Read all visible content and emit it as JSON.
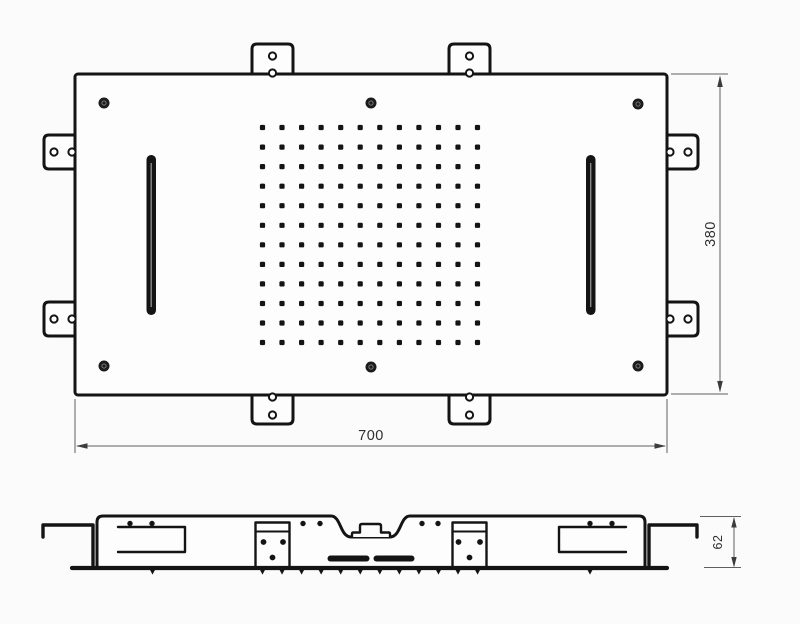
{
  "dimensions": {
    "width": "700",
    "height": "380",
    "depth": "62"
  },
  "colors": {
    "line": "#141414",
    "dim_line": "#5f5f5f",
    "text": "#2e2e2e",
    "background": "#fbfbfb",
    "panel_fill": "#fdfdfd"
  },
  "spray_grid": {
    "rows": 12,
    "cols": 12
  },
  "counts": {
    "corner_screws": 6,
    "mounting_tabs": 4,
    "side_brackets": 4,
    "waterfall_slots": 2,
    "bottom_nozzle_ticks": 14
  }
}
